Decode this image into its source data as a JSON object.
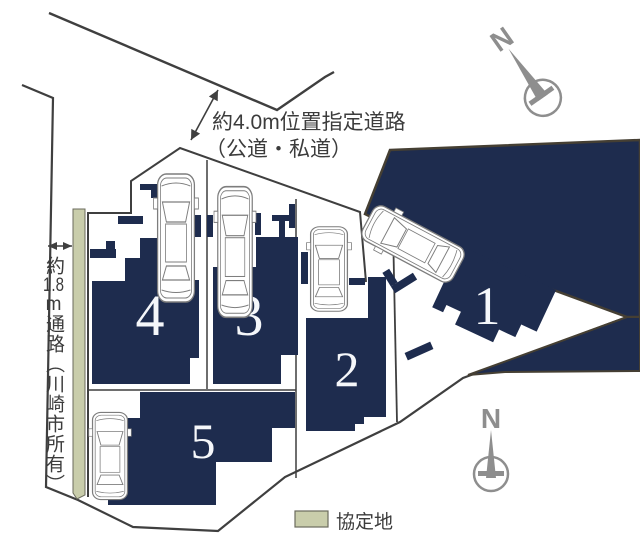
{
  "colors": {
    "navy": "#1e2c4e",
    "agreement_green": "#c9cdab",
    "line": "#3f3f3f",
    "parcel_border": "#453f33",
    "compass_gray": "#8e8e8e",
    "text": "#3c3c3c",
    "number_white": "#f5f7fa"
  },
  "road_label": {
    "line1": "約4.0m位置指定道路",
    "line2": "（公道・私道）"
  },
  "passage_label": {
    "part1": "約",
    "part2": "1.8",
    "part3": "m",
    "part4": "通路（川崎市所有）"
  },
  "legend": {
    "label": "協定地"
  },
  "compass": {
    "label": "N"
  },
  "lots": [
    {
      "number": "1"
    },
    {
      "number": "2"
    },
    {
      "number": "3"
    },
    {
      "number": "4"
    },
    {
      "number": "5"
    }
  ]
}
